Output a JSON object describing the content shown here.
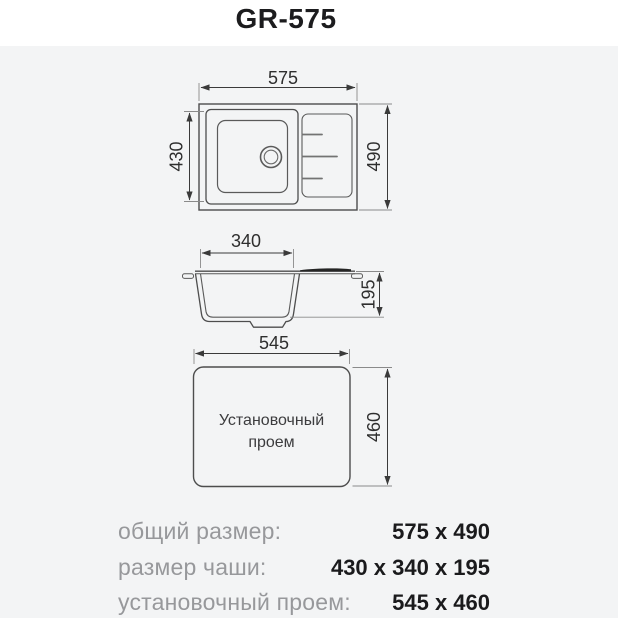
{
  "title": "GR-575",
  "views": {
    "top": {
      "overall_width": "575",
      "overall_depth": "490",
      "bowl_depth": "430"
    },
    "section": {
      "bowl_length": "340",
      "bowl_height": "195"
    },
    "cutout": {
      "width": "545",
      "depth": "460",
      "caption_line1": "Установочный",
      "caption_line2": "проем"
    }
  },
  "specs": [
    {
      "label": "общий размер:",
      "value": "575 x 490"
    },
    {
      "label": "размер чаши:",
      "value": "430 x 340 x 195"
    },
    {
      "label": "установочный проем:",
      "value": "545 x 460"
    }
  ],
  "colors": {
    "panel_bg": "#f3f4f5",
    "drawing_line": "#4d4d4d",
    "dimension_line": "#3a3a3a",
    "dim_text": "#2e2e2e",
    "label_gray": "#97989b",
    "value_black": "#1a1a1c",
    "drainboard_fill": "#242424"
  }
}
